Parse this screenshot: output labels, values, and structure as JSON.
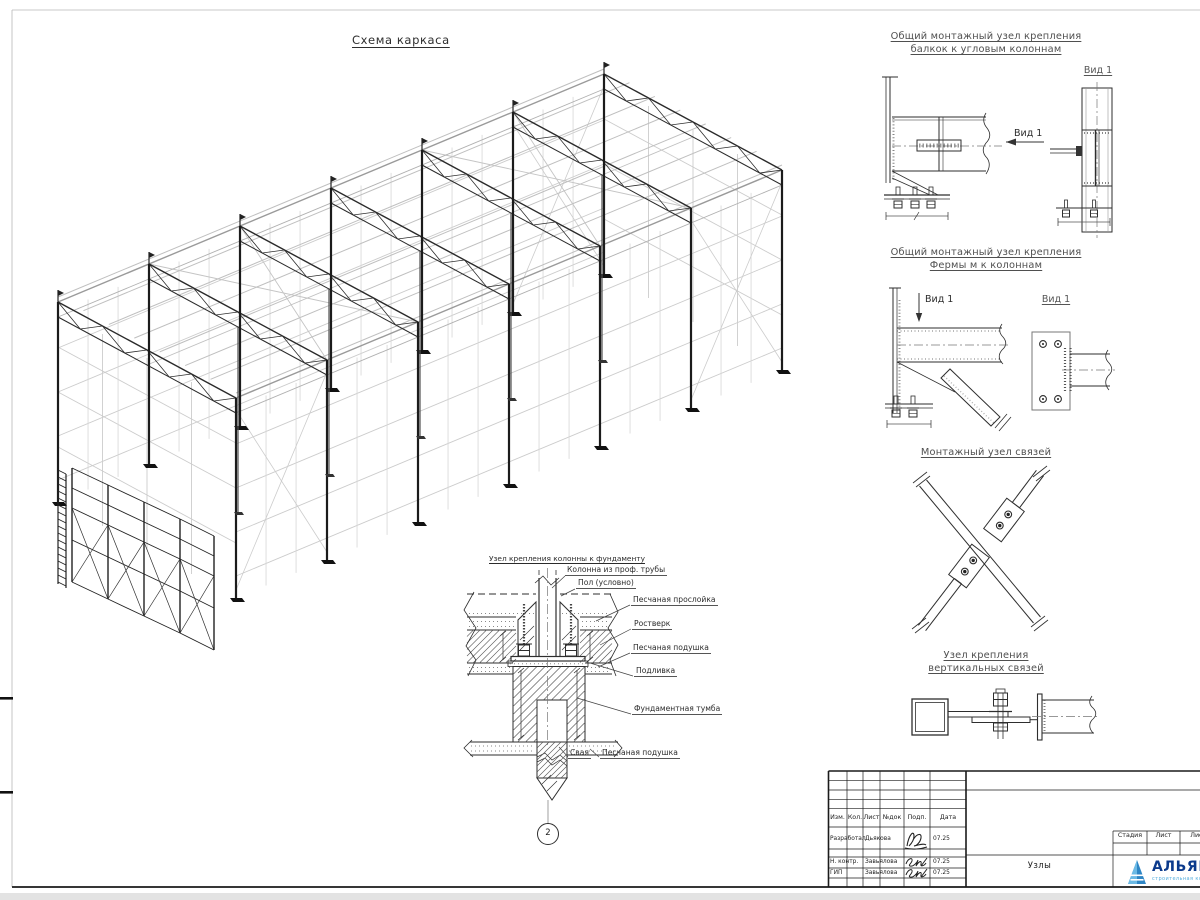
{
  "sheet": {
    "main_title": "Схема каркаса"
  },
  "details": {
    "d1_title_1": "Общий монтажный узел крепления",
    "d1_title_2": "балкок к угловым колоннам",
    "d1_view_title": "Вид 1",
    "d1_view_arrow": "Вид 1",
    "d2_title_1": "Общий монтажный узел крепления",
    "d2_title_2": "Фермы м к колоннам",
    "d2_view_title": "Вид 1",
    "d2_view_arrow": "Вид 1",
    "d3_title": "Монтажный узел связей",
    "d4_title_1": "Узел крепления",
    "d4_title_2": "вертикальных связей"
  },
  "foundation": {
    "title": "Узел крепления колонны к фундаменту",
    "labels": {
      "column": "Колонна из проф. трубы",
      "floor": "Пол (условно)",
      "sand_layer": "Песчаная прослойка",
      "grillage": "Ростверк",
      "sand_cushion": "Песчаная подушка",
      "grout": "Подливка",
      "block": "Фундаментная тумба",
      "pile": "Свая",
      "sand_cushion2": "Песчаная подушка"
    },
    "marker": "2"
  },
  "title_block": {
    "headers": [
      "Изм.",
      "Кол.",
      "Лист",
      "№док",
      "Подп.",
      "Дата"
    ],
    "rows": [
      {
        "role": "Разработал",
        "name": "Дьякова",
        "date": "07.25"
      },
      {
        "role": "Н. контр.",
        "name": "Завьялова",
        "date": "07.25"
      },
      {
        "role": "ГИП",
        "name": "Завьялова",
        "date": "07.25"
      }
    ],
    "stage_label": "Стадия",
    "sheet_label": "Лист",
    "sheets_label": "Листов",
    "doc_name": "Узлы",
    "logo_text": "АЛЬЯНС",
    "logo_subtext": "строительная компания"
  },
  "colors": {
    "line_dark": "#1c1c1c",
    "line_light": "#c9c9c9",
    "title_gray": "#4f4f4f",
    "logo_navy": "#0b3a8c",
    "logo_blue": "#3a93d0",
    "logo_light_blue": "#77c3ea"
  }
}
